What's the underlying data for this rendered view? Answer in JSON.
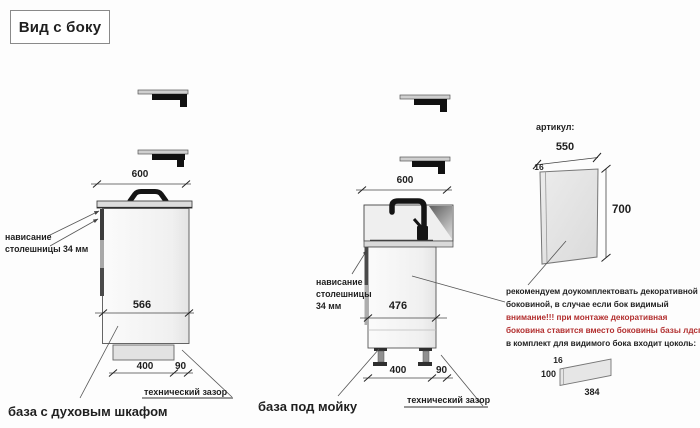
{
  "page": {
    "title": "Вид с боку"
  },
  "colors": {
    "warning_red": "#b22f2f",
    "text_black": "#1f1f1f",
    "line_gray": "#444444"
  },
  "oven_base": {
    "label": "база с духовым шкафом",
    "top_width_mm": "600",
    "body_depth_mm": "566",
    "plinth_depth_mm": "400",
    "gap_mm": "90",
    "overhang_line1": "нависание",
    "overhang_line2": "столешницы 34 мм",
    "tech_gap_label": "технический зазор"
  },
  "sink_base": {
    "label": "база под мойку",
    "top_width_mm": "600",
    "body_depth_mm": "476",
    "plinth_depth_mm": "400",
    "gap_mm": "90",
    "overhang_line1": "нависание",
    "overhang_line2": "столешницы",
    "overhang_line3": "34 мм",
    "tech_gap_label": "технический зазор"
  },
  "decor_panel": {
    "heading": "артикул:",
    "width_mm": "550",
    "thickness_mm": "16",
    "height_mm": "700",
    "note_line1": "рекомендуем доукомплектовать декоративной",
    "note_line2": "боковиной, в случае если бок видимый",
    "warning_line1": "внимание!!! при монтаже декоративная",
    "warning_line2": "боковина ставится вместо боковины базы лдсп",
    "note_line3": "в комплект для видимого бока входит цоколь:"
  },
  "plinth_item": {
    "thickness_mm": "16",
    "height_mm": "100",
    "length_mm": "384"
  }
}
